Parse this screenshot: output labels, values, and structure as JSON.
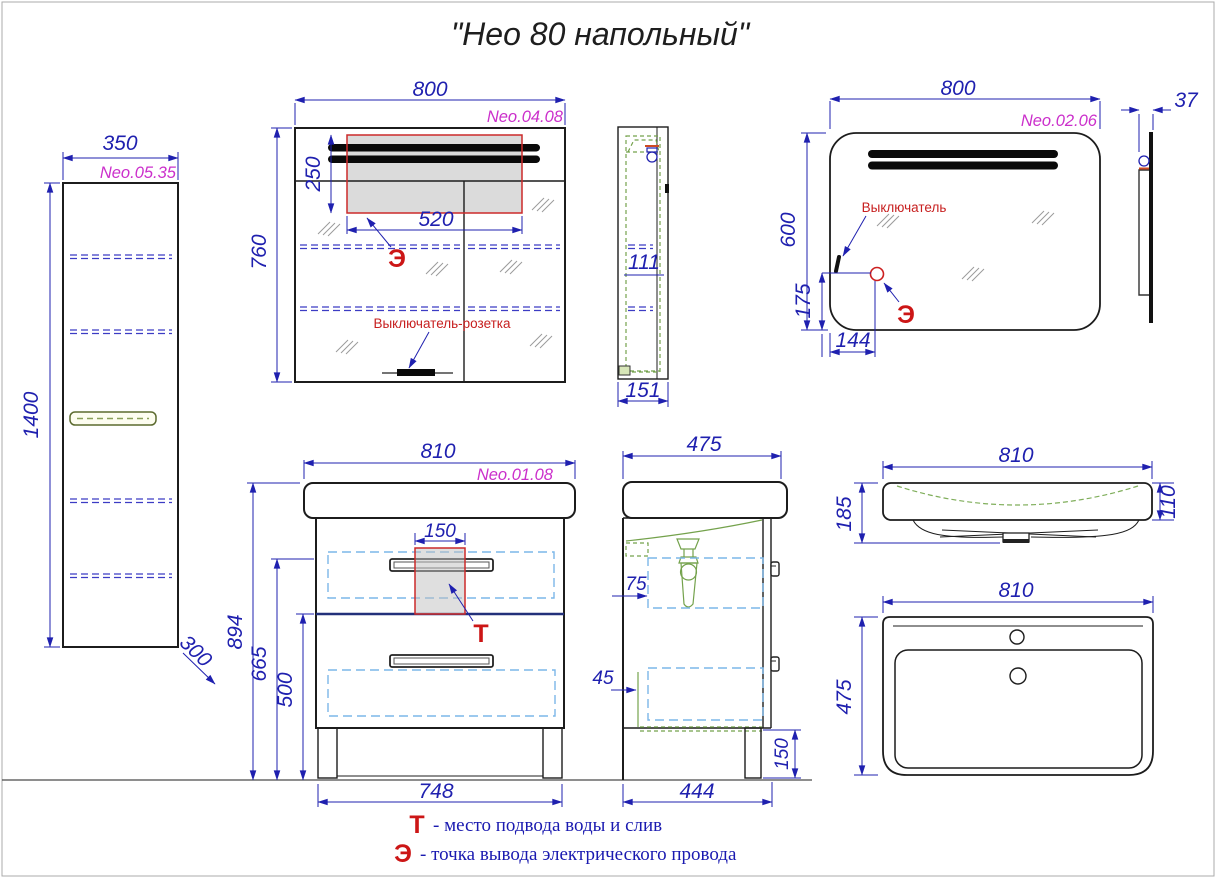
{
  "title": "\"Нео 80 напольный\"",
  "views": {
    "tall_cabinet": {
      "code": "Neo.05.35",
      "width": "350",
      "height": "1400",
      "depth": "300"
    },
    "mirror_cabinet": {
      "code": "Neo.04.08",
      "width": "800",
      "height": "760",
      "lamp_width": "520",
      "lamp_height": "250",
      "shelf": "111",
      "side_depth": "151",
      "switch_label": "Выключатель-розетка",
      "e_marker": "Э"
    },
    "mirror": {
      "code": "Neo.02.06",
      "width": "800",
      "height": "600",
      "e_offset_x": "144",
      "e_offset_y": "175",
      "thickness": "37",
      "switch_label": "Выключатель",
      "e_marker": "Э"
    },
    "vanity": {
      "code": "Neo.01.08",
      "width": "810",
      "height": "894",
      "mid_height": "665",
      "drawer_height": "500",
      "legs_span": "748",
      "drain_width": "150",
      "t_marker": "Т"
    },
    "vanity_side": {
      "depth": "475",
      "back_gap": "75",
      "side_gap": "45",
      "bottom_width": "444",
      "leg_height": "150"
    },
    "sink": {
      "width": "810",
      "front_height": "185",
      "rim_height": "110",
      "depth": "475"
    }
  },
  "legend": {
    "t_marker": "Т",
    "t_text": "- место подвода воды и слив",
    "e_marker": "Э",
    "e_text": "- точка вывода электрического провода"
  },
  "colors": {
    "dimension_blue": "#1f20af",
    "code_magenta": "#cb2fcb",
    "annotation_red": "#cc1616",
    "drawer_dash_blue": "#7cb7e8",
    "detail_green": "#74a24c",
    "outline_black": "#1c1c1c"
  }
}
